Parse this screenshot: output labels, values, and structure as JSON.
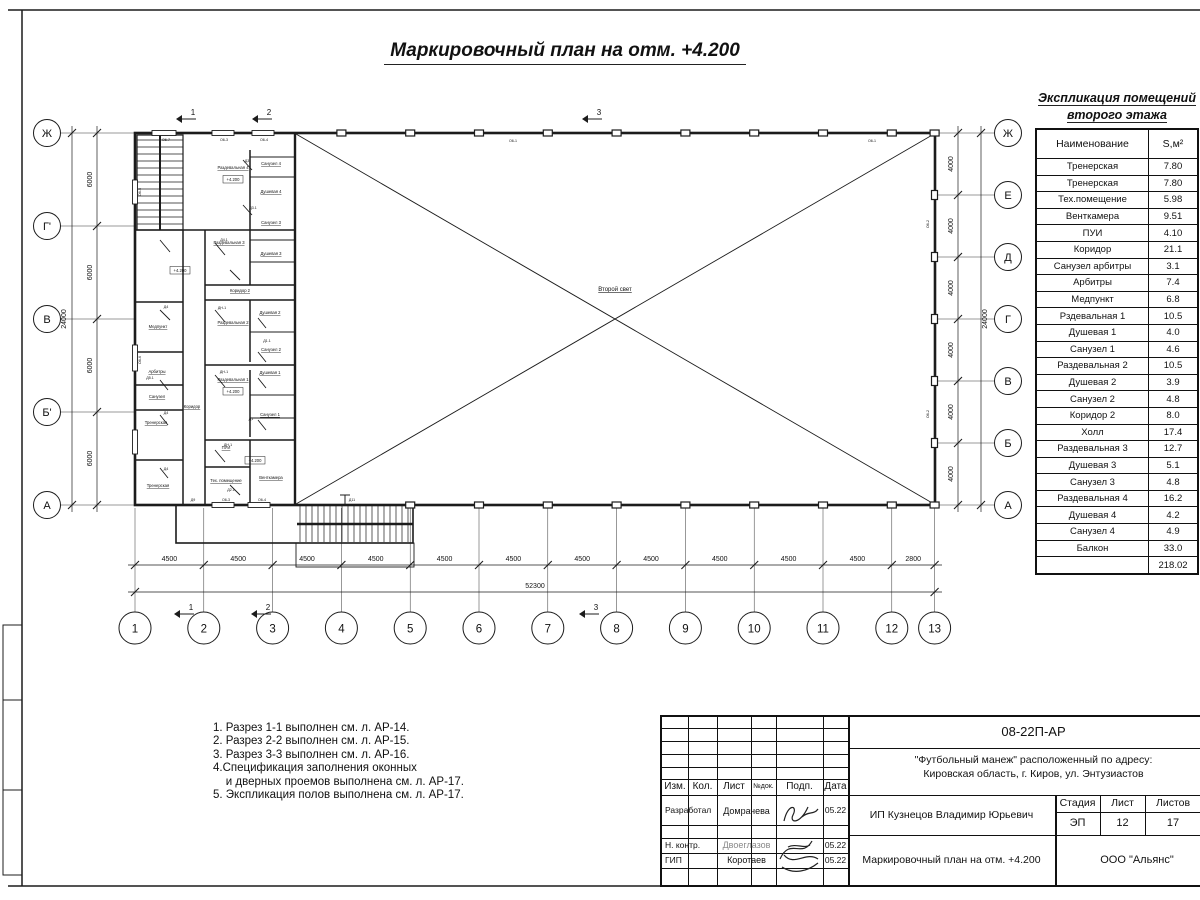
{
  "sheet": {
    "title": "Маркировочный план на отм. +4.200"
  },
  "explication": {
    "title_line1": "Экспликация помещений",
    "title_line2": "второго этажа",
    "col_name": "Наименование",
    "col_area": "S,м²",
    "rows": [
      [
        "Тренерская",
        "7.80"
      ],
      [
        "Тренерская",
        "7.80"
      ],
      [
        "Тех.помещение",
        "5.98"
      ],
      [
        "Венткамера",
        "9.51"
      ],
      [
        "ПУИ",
        "4.10"
      ],
      [
        "Коридор",
        "21.1"
      ],
      [
        "Санузел арбитры",
        "3.1"
      ],
      [
        "Арбитры",
        "7.4"
      ],
      [
        "Медпункт",
        "6.8"
      ],
      [
        "Рздевальная 1",
        "10.5"
      ],
      [
        "Душевая 1",
        "4.0"
      ],
      [
        "Санузел 1",
        "4.6"
      ],
      [
        "Раздевальная 2",
        "10.5"
      ],
      [
        "Душевая 2",
        "3.9"
      ],
      [
        "Санузел 2",
        "4.8"
      ],
      [
        "Коридор 2",
        "8.0"
      ],
      [
        "Холл",
        "17.4"
      ],
      [
        "Раздевальная 3",
        "12.7"
      ],
      [
        "Душевая 3",
        "5.1"
      ],
      [
        "Санузел 3",
        "4.8"
      ],
      [
        "Раздевальная 4",
        "16.2"
      ],
      [
        "Душевая 4",
        "4.2"
      ],
      [
        "Санузел 4",
        "4.9"
      ],
      [
        "Балкон",
        "33.0"
      ]
    ],
    "total": "218.02"
  },
  "notes": {
    "lines": [
      "1. Разрез 1-1 выполнен см. л. АР-14.",
      "2. Разрез 2-2 выполнен см. л. АР-15.",
      "3. Разрез 3-3 выполнен см. л. АР-16.",
      "4.Спецификация заполнения оконных",
      "    и дверных проемов выполнена см. л. АР-17.",
      "5. Экспликация полов выполнена см. л. АР-17."
    ]
  },
  "plan": {
    "axes_left": [
      "Ж",
      "Г'",
      "В",
      "Б'",
      "А"
    ],
    "axes_right": [
      "Ж",
      "Е",
      "Д",
      "Г",
      "В",
      "Б",
      "А"
    ],
    "axes_bottom": [
      "1",
      "2",
      "3",
      "4",
      "5",
      "6",
      "7",
      "8",
      "9",
      "10",
      "11",
      "12",
      "13"
    ],
    "dims_left": [
      "6000",
      "6000",
      "6000",
      "6000"
    ],
    "dims_left_total": "24000",
    "dims_right": [
      "4000",
      "4000",
      "4000",
      "4000",
      "4000",
      "4000"
    ],
    "dims_right_total": "24000",
    "dims_bottom": [
      "4500",
      "4500",
      "4500",
      "4500",
      "4500",
      "4500",
      "4500",
      "4500",
      "4500",
      "4500",
      "4500",
      "2800"
    ],
    "dims_bottom_total": "52300",
    "section_markers": [
      "1",
      "2",
      "3"
    ],
    "void_label": "Второй свет",
    "level_mark": "+4.200",
    "room_labels": [
      "Раздевальная 4",
      "Санузел 4",
      "Душевая 4",
      "Раздевальная 3",
      "Санузел 3",
      "Душевая 3",
      "Коридор 2",
      "Раздевальная 2",
      "Душевая 2",
      "Санузел 2",
      "Раздевальная 1",
      "Душевая 1",
      "Санузел 1",
      "ПУИ",
      "Тех. помещение",
      "Венткамера",
      "Коридор",
      "Медпункт",
      "Арбитры",
      "Санузел",
      "Тренерская",
      "Тренерская"
    ],
    "wall_tags": [
      "О6-7",
      "О6-3",
      "О6-4",
      "О6-1",
      "О6-1",
      "О6-2",
      "О6-2",
      "О6-5",
      "О6-6",
      "Д9",
      "О6-3",
      "О6-4",
      "Д11",
      "Д4.1",
      "Д3",
      "ДН-1",
      "Д1",
      "Д3.1",
      "Д4",
      "Д2.1",
      "ДН-1",
      "Д1.1",
      "Д4",
      "Д5.1",
      "Д4",
      "ДН-1"
    ]
  },
  "title_block": {
    "doc_code": "08-22П-АР",
    "object_line1": "\"Футбольный манеж\" расположенный по адресу:",
    "object_line2": "Кировская область, г. Киров, ул. Энтузиастов",
    "cols": {
      "izm": "Изм.",
      "kol": "Кол.",
      "list": "Лист",
      "ndok": "№док.",
      "podp": "Подп.",
      "data": "Дата"
    },
    "row_developed": {
      "role": "Разработал",
      "name": "Домрачева",
      "date": "05.22"
    },
    "row_ncontr": {
      "role": "Н. контр.",
      "name": "Двоеглазов",
      "date": "05.22"
    },
    "row_gip": {
      "role": "ГИП",
      "name": "Коротаев",
      "date": "05.22"
    },
    "client": "ИП Кузнецов Владимир Юрьевич",
    "stage_label": "Стадия",
    "stage": "ЭП",
    "sheet_label": "Лист",
    "sheet_num": "12",
    "sheets_label": "Листов",
    "sheets_total": "17",
    "drawing_title": "Маркировочный план на отм. +4.200",
    "company": "ООО \"Альянс\""
  }
}
